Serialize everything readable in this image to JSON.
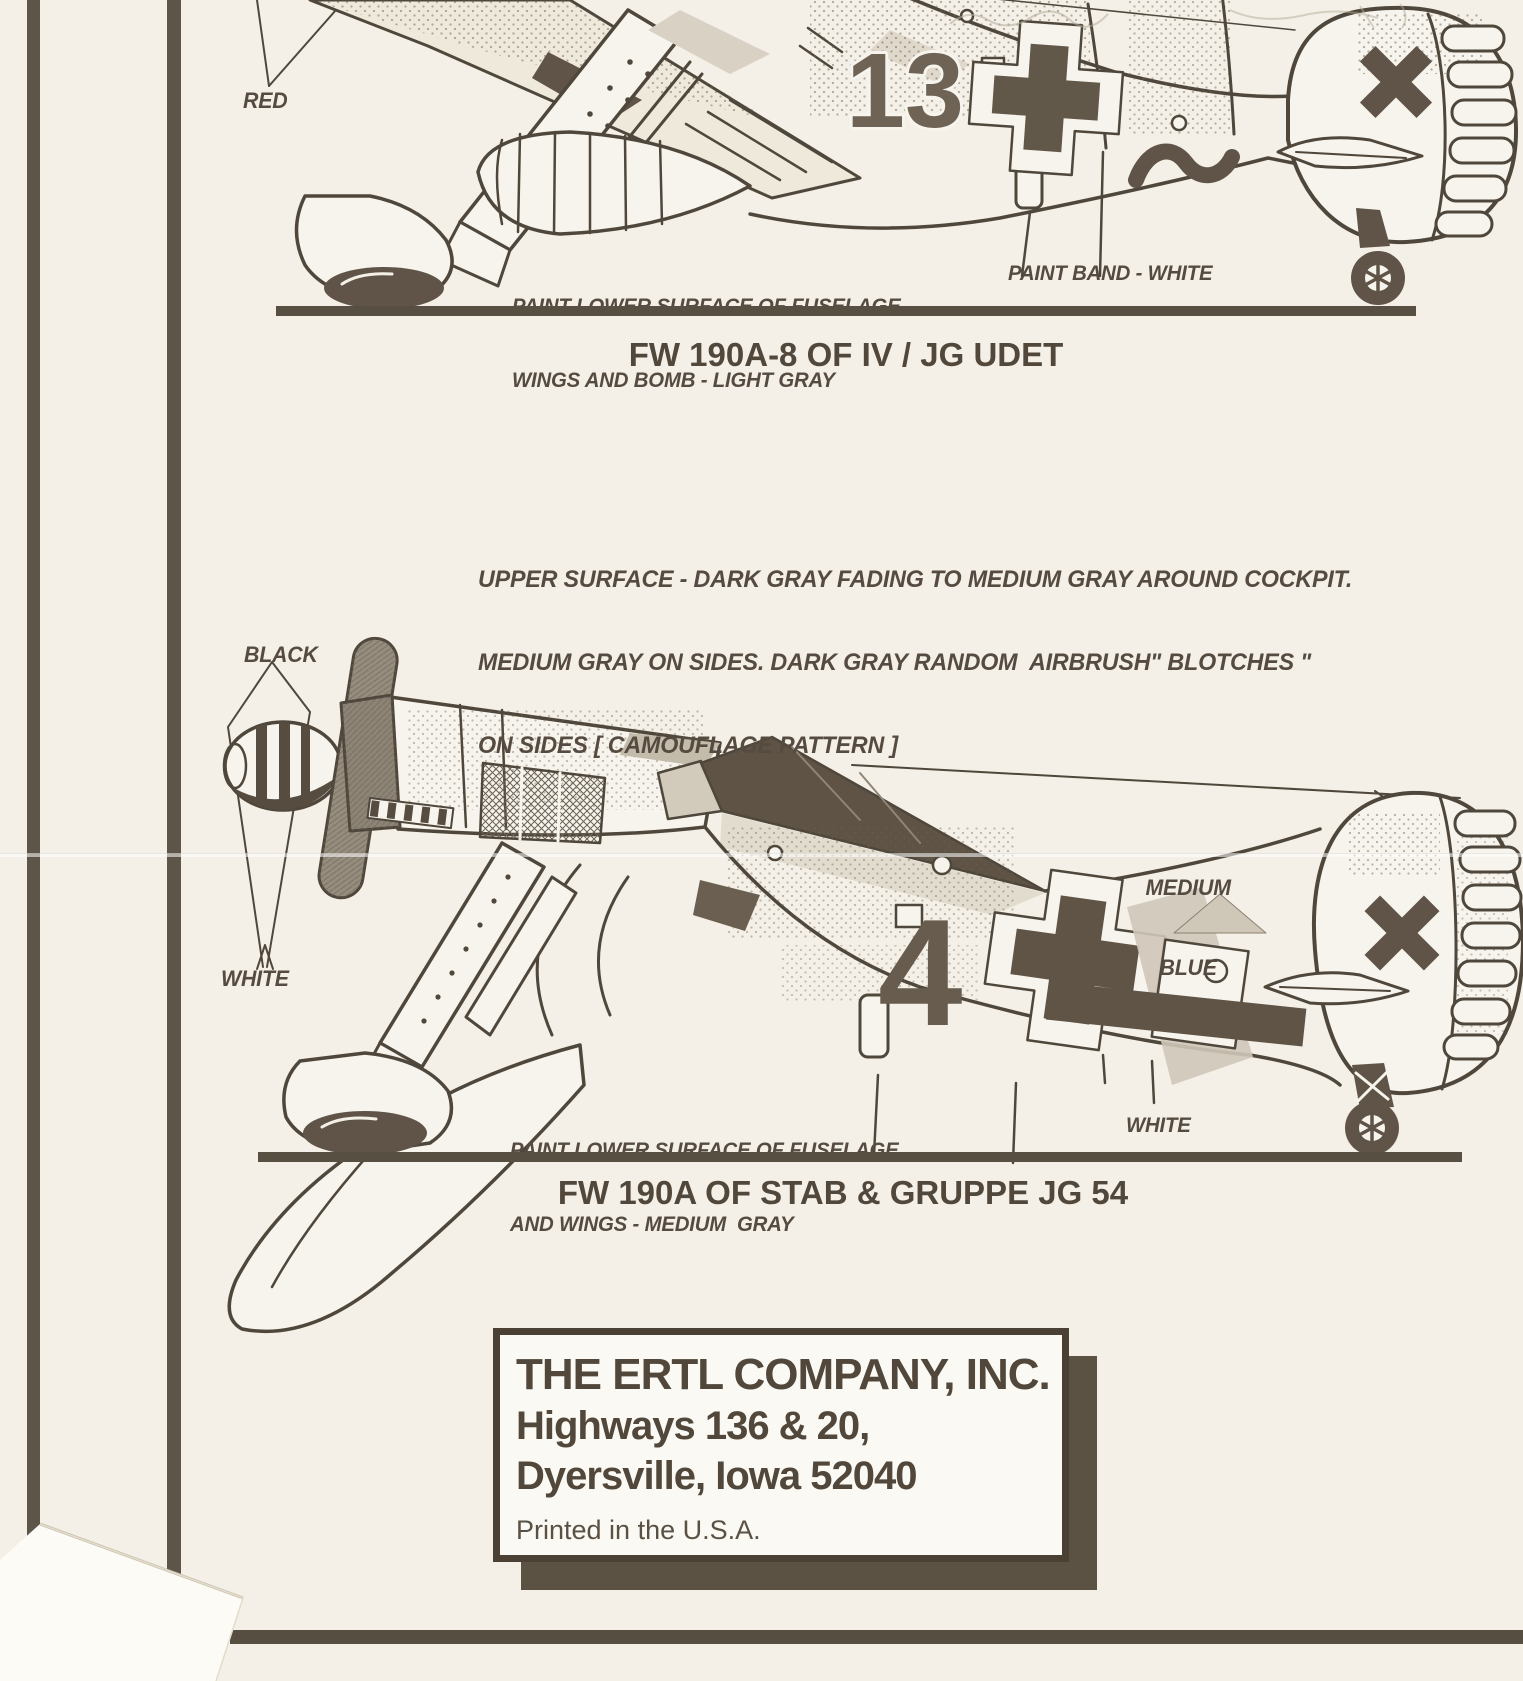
{
  "document": {
    "kind": "model kit painting instructions (scanned sheet)",
    "paper_color": "#f4f0e7",
    "ink_color": "#4f473b",
    "dark_fill": "#5f5447",
    "light_shade": "#d5cec0"
  },
  "top_diagram": {
    "label_red": "RED",
    "paint_note_line1": "PAINT LOWER SURFACE OF FUSELAGE",
    "paint_note_line2": "WINGS AND BOMB - LIGHT GRAY",
    "label_paint_band": "PAINT BAND - WHITE",
    "fuselage_number": "13",
    "caption": "FW 190A-8 OF IV / JG UDET"
  },
  "camouflage_note": {
    "line1": "UPPER SURFACE - DARK GRAY FADING TO MEDIUM GRAY AROUND COCKPIT.",
    "line2": "MEDIUM GRAY ON SIDES. DARK GRAY RANDOM  AIRBRUSH\" BLOTCHES \"",
    "line3": "ON SIDES [ CAMOUFLAGE PATTERN ]"
  },
  "bottom_diagram": {
    "label_black": "BLACK",
    "label_white_left": "WHITE",
    "label_medium_blue_line1": "MEDIUM",
    "label_medium_blue_line2": "BLUE",
    "fuselage_number": "4",
    "paint_note_line1": "PAINT LOWER SURFACE OF FUSELAGE",
    "paint_note_line2": "AND WINGS - MEDIUM  GRAY",
    "label_white_right": "WHITE",
    "caption": "FW 190A OF STAB & GRUPPE JG 54"
  },
  "publisher_box": {
    "company": "THE ERTL COMPANY, INC.",
    "address_line1": "Highways 136 & 20,",
    "address_line2": "Dyersville, Iowa 52040",
    "printed_note": "Printed in the U.S.A."
  }
}
